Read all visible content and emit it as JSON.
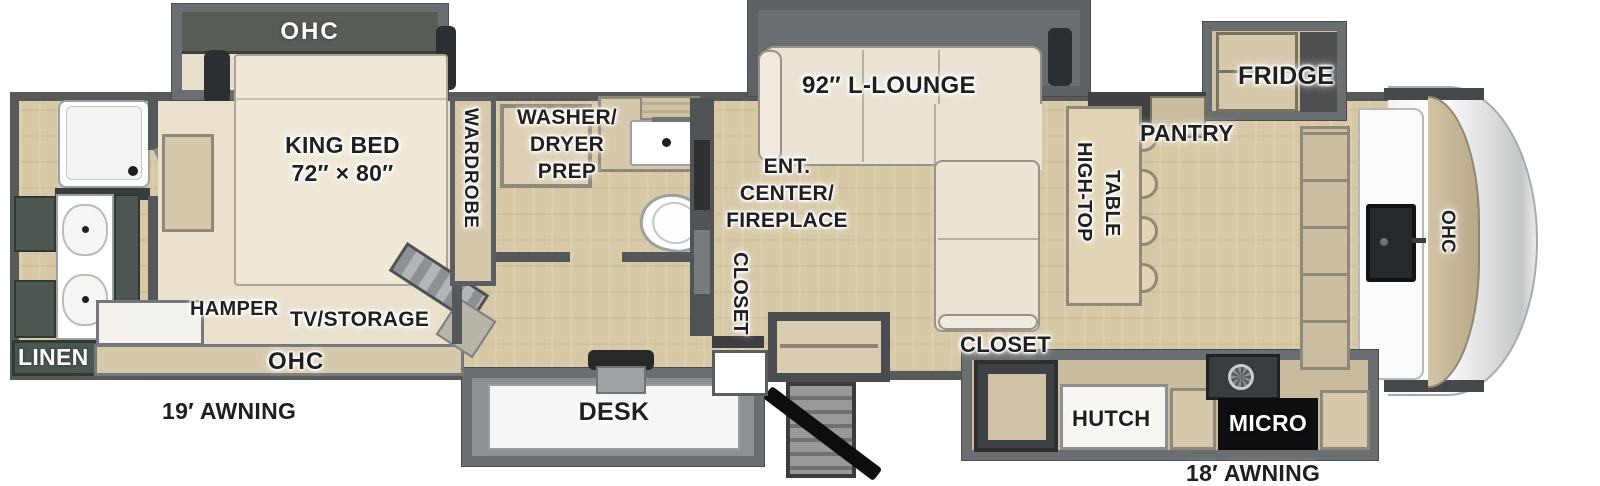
{
  "diagram_title": "Fifth Wheel RV Floorplan",
  "colors": {
    "wall": "#57595b",
    "floor_wood": "#d7c8a6",
    "carpet": "#e9e1cd",
    "cabinet_tan": "#d6c8ab",
    "cabinet_green": "#4b5750",
    "slide_band_dark": "#575c55",
    "label_text": "#1f1f1f",
    "label_text_inverse": "#ffffff"
  },
  "labels": {
    "bedroom_ohc": "OHC",
    "king_bed_line1": "KING BED",
    "king_bed_line2": "72″ × 80″",
    "wardrobe": "WARDROBE",
    "hamper": "HAMPER",
    "tv_storage": "TV/STORAGE",
    "bedroom_dresser_ohc": "OHC",
    "linen": "LINEN",
    "washer_line1": "WASHER/",
    "washer_line2": "DRYER",
    "washer_line3": "PREP",
    "desk": "DESK",
    "lounge": "92″ L-LOUNGE",
    "ent_line1": "ENT.",
    "ent_line2": "CENTER/",
    "ent_line3": "FIREPLACE",
    "closet_hall": "CLOSET",
    "closet_kitchen": "CLOSET",
    "high_top_line1": "HIGH-TOP",
    "high_top_line2": "TABLE",
    "pantry": "PANTRY",
    "fridge": "FRIDGE",
    "hutch": "HUTCH",
    "micro": "MICRO",
    "front_ohc": "OHC",
    "awning_left": "19′ AWNING",
    "awning_right": "18′ AWNING"
  }
}
